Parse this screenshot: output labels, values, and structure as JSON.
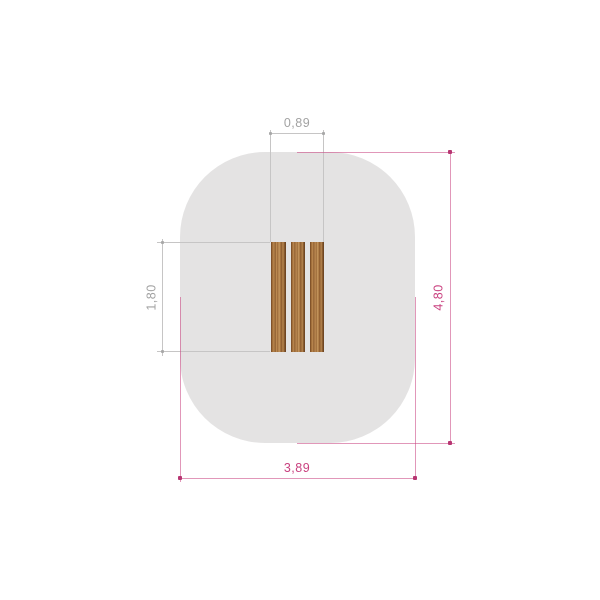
{
  "drawing": {
    "type": "technical-plan-top-view",
    "zone": {
      "fill_color": "#e4e3e3",
      "shape": "rounded-rectangle-safety-zone"
    },
    "planks": {
      "count": 3,
      "wood_colors": [
        "#66401f",
        "#8a5a2e",
        "#a9763f",
        "#c79a62"
      ]
    },
    "dimensions": {
      "plank_width": {
        "label": "0,89",
        "color": "#a2a2a2"
      },
      "plank_height": {
        "label": "1,80",
        "color": "#a2a2a2"
      },
      "zone_width": {
        "label": "3,89",
        "color": "#c9417f"
      },
      "zone_height": {
        "label": "4,80",
        "color": "#c9417f"
      }
    },
    "style": {
      "dim_line_gray": "#c6c5c5",
      "dim_line_pink": "#c9417f",
      "background": "#ffffff"
    }
  }
}
